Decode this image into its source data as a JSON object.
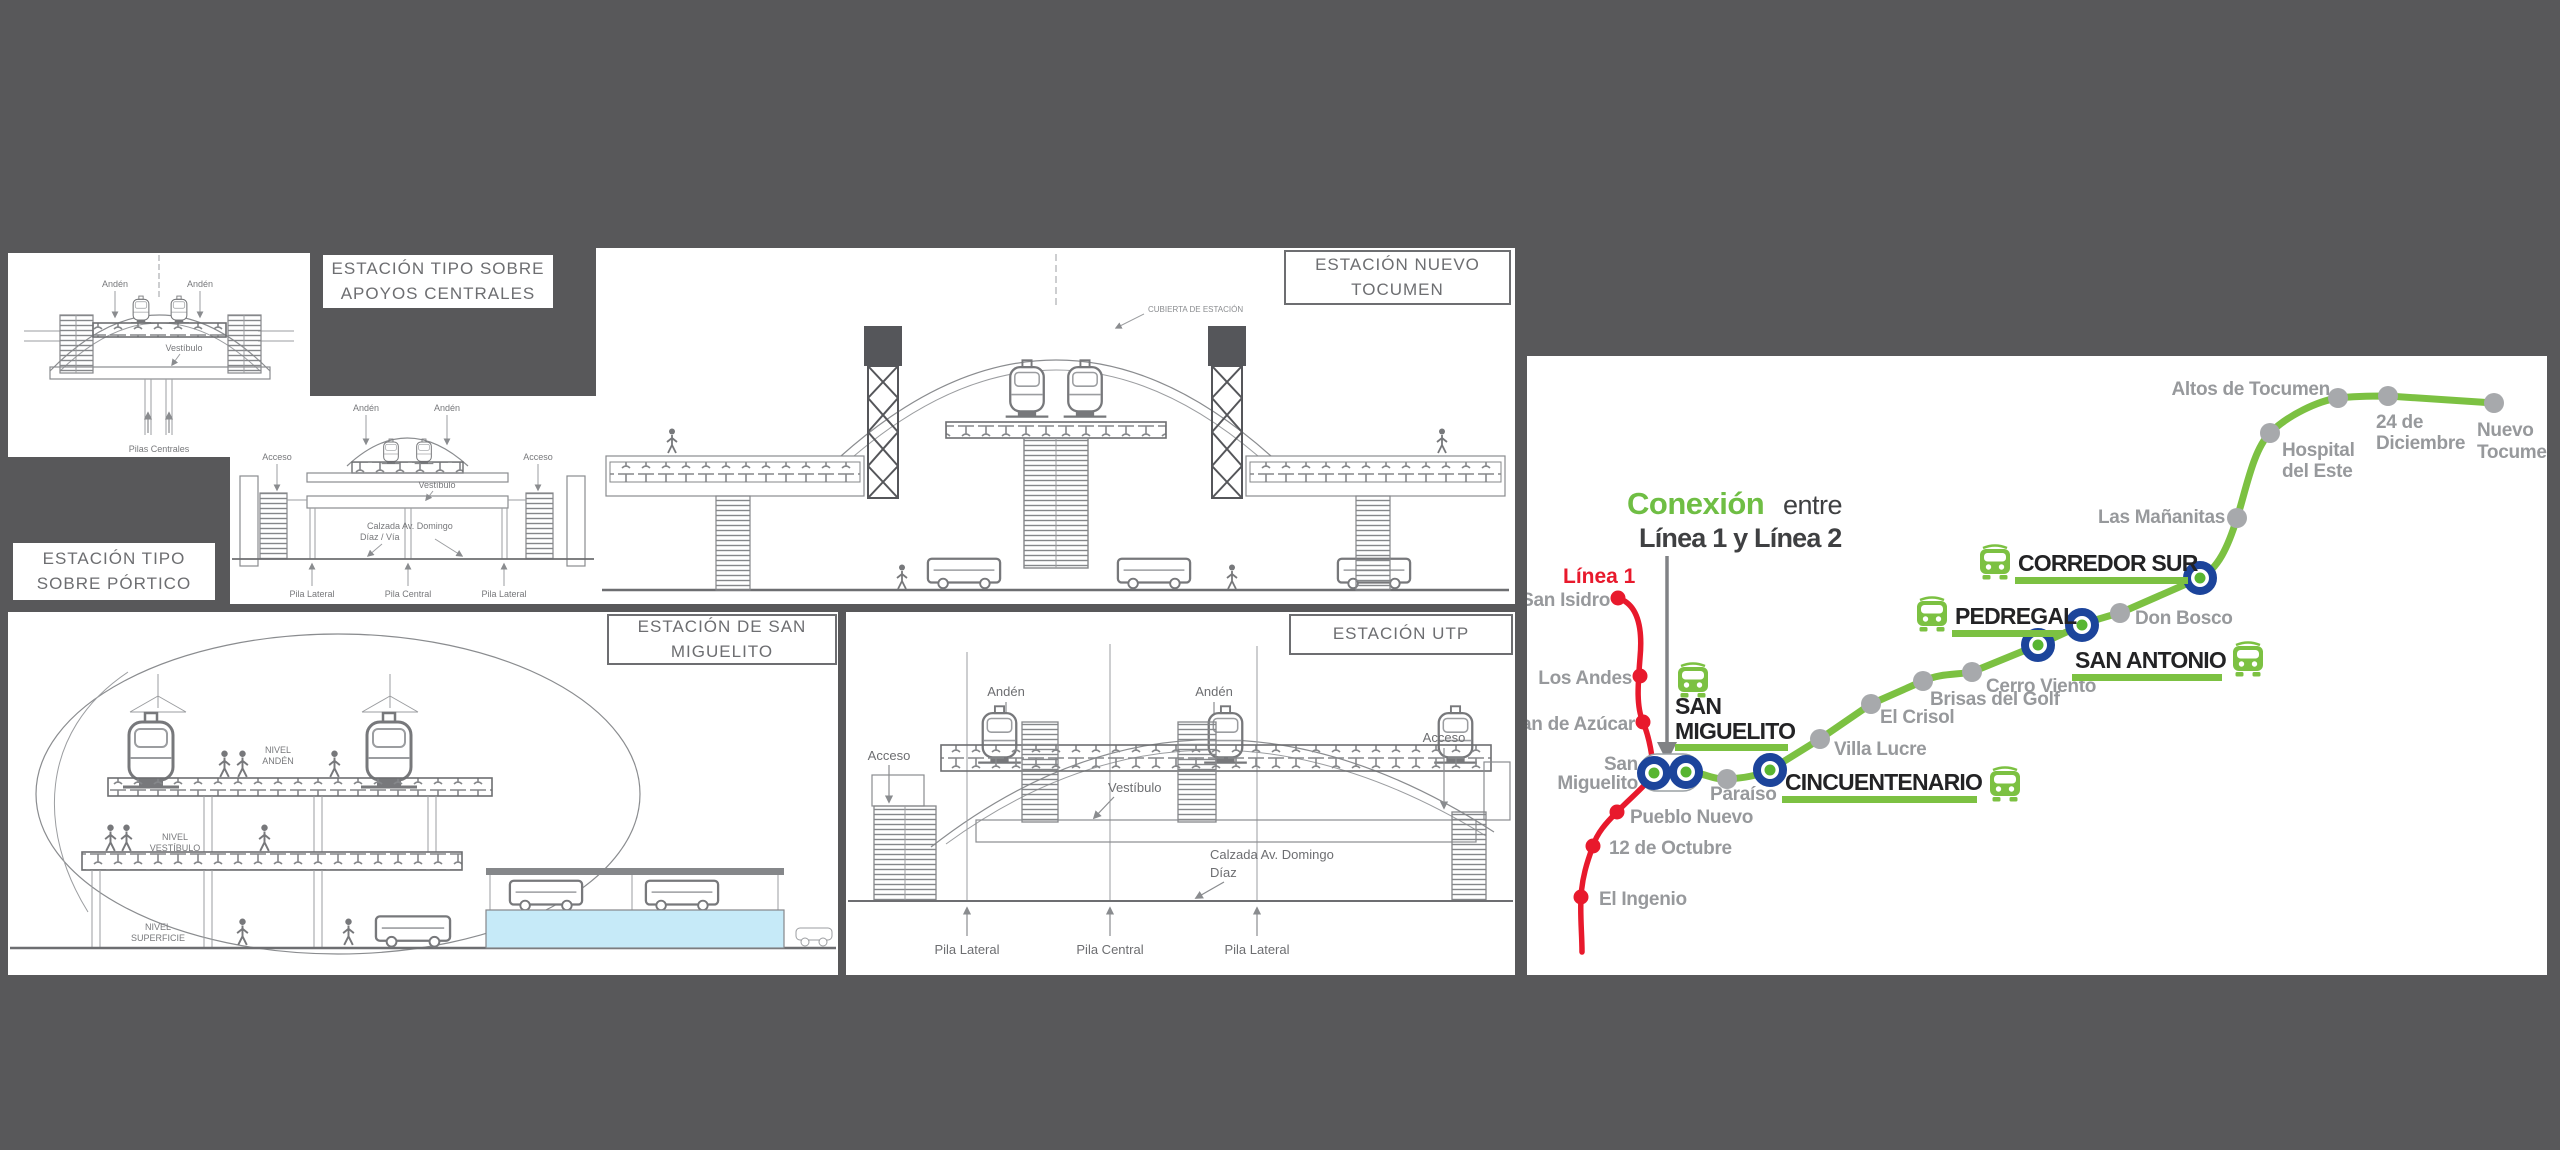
{
  "colors": {
    "background": "#58585a",
    "panel_white": "#ffffff",
    "drawing_gray": "#8a8c8f",
    "label_gray": "#6d6e71",
    "map_green": "#7cc142",
    "map_red": "#e8192c",
    "interchange_blue": "#1c449b",
    "station_label_gray": "#97999c",
    "minor_dot_gray": "#a7a9ac",
    "major_text_dark": "#232325",
    "cyan_slab": "#c6eaf8"
  },
  "panels": {
    "tipo_apoyos": {
      "title": "ESTACIÓN TIPO SOBRE APOYOS CENTRALES",
      "labels": {
        "anden_left": "Andén",
        "anden_right": "Andén",
        "vestibulo": "Vestíbulo",
        "pilas_centrales": "Pilas Centrales"
      }
    },
    "tipo_portico": {
      "title": "ESTACIÓN TIPO SOBRE PÓRTICO",
      "labels": {
        "anden_left": "Andén",
        "anden_right": "Andén",
        "acceso_left": "Acceso",
        "acceso_right": "Acceso",
        "vestibulo": "Vestíbulo",
        "calzada_line1": "Calzada Av. Domingo",
        "calzada_line2": "Díaz / Vía",
        "pila_lateral_left": "Pila Lateral",
        "pila_central": "Pila Central",
        "pila_lateral_right": "Pila Lateral"
      }
    },
    "nuevo_tocumen": {
      "title": "ESTACIÓN NUEVO TOCUMEN",
      "labels": {
        "cubierta": "CUBIERTA DE ESTACIÓN"
      }
    },
    "san_miguelito": {
      "title": "ESTACIÓN DE SAN MIGUELITO",
      "labels": {
        "nivel_anden_1": "NIVEL",
        "nivel_anden_2": "ANDÉN",
        "nivel_vestibulo_1": "NIVEL",
        "nivel_vestibulo_2": "VESTÍBULO",
        "nivel_superficie_1": "NIVEL",
        "nivel_superficie_2": "SUPERFICIE"
      }
    },
    "utp": {
      "title": "ESTACIÓN UTP",
      "labels": {
        "anden_left": "Andén",
        "anden_right": "Andén",
        "acceso_left": "Acceso",
        "acceso_right": "Acceso",
        "vestibulo": "Vestíbulo",
        "calzada_line1": "Calzada Av. Domingo",
        "calzada_line2": "Díaz",
        "pila_lateral_left": "Pila Lateral",
        "pila_central": "Pila Central",
        "pila_lateral_right": "Pila Lateral"
      }
    }
  },
  "map": {
    "connection": {
      "highlight": "Conexión",
      "rest": "entre",
      "line2": "Línea 1 y Línea 2"
    },
    "linea1_label": "Línea 1",
    "line1_stations": [
      {
        "name": "San Isidro"
      },
      {
        "name": "Los Andes"
      },
      {
        "name": "Pan de Azúcar"
      },
      {
        "name_line1": "San",
        "name_line2": "Miguelito"
      },
      {
        "name": "Pueblo Nuevo"
      },
      {
        "name": "12 de Octubre"
      },
      {
        "name": "El Ingenio"
      }
    ],
    "line2_minor_stations": [
      {
        "name": "Paraíso"
      },
      {
        "name": "Villa Lucre"
      },
      {
        "name": "El Crisol"
      },
      {
        "name": "Brisas del Golf"
      },
      {
        "name": "Cerro Viento"
      },
      {
        "name": "Don Bosco"
      },
      {
        "name": "Las Mañanitas"
      },
      {
        "name_line1": "Hospital",
        "name_line2": "del Este"
      },
      {
        "name": "Altos de Tocumen"
      },
      {
        "name_line1": "24 de",
        "name_line2": "Diciembre"
      },
      {
        "name_line1": "Nuevo",
        "name_line2": "Tocumen"
      }
    ],
    "line2_major_stations": [
      {
        "name_line1": "SAN",
        "name_line2": "MIGUELITO"
      },
      {
        "name": "CINCUENTENARIO"
      },
      {
        "name": "SAN ANTONIO"
      },
      {
        "name": "PEDREGAL"
      },
      {
        "name": "CORREDOR SUR"
      }
    ]
  }
}
